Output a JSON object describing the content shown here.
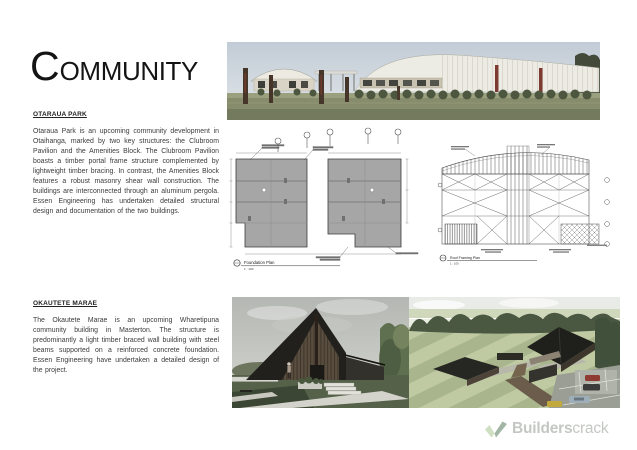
{
  "page": {
    "title_initial": "C",
    "title_rest": "OMMUNITY"
  },
  "sections": {
    "otaraua": {
      "heading": "OTARAUA PARK",
      "body": "Otaraua Park is an upcoming community development in Otaihanga, marked by two key structures: the Clubroom Pavilion and the Amenities Block. The Clubroom Pavilion boasts a timber portal frame structure complemented by lightweight timber bracing. In contrast, the Amenities Block features a robust masonry shear wall construction. The buildings are interconnected through an aluminum pergola. Essen Engineering has undertaken detailed structural design and documentation of the two buildings."
    },
    "okautete": {
      "heading": "OKAUTETE MARAE",
      "body": "The Okautete Marae is an upcoming Wharetipuna community building in Masterton. The structure is predominantly a light timber braced wall building with steel beams supported on a reinforced concrete foundation. Essen Engineering have undertaken a detailed design of the project."
    }
  },
  "drawings": {
    "foundation_plan": {
      "label": "Foundation Plan",
      "scale": "1 : 100"
    },
    "roof_plan": {
      "label": "Roof Framing Plan",
      "scale": "1 : 100"
    }
  },
  "logo": {
    "brand_bold": "Builders",
    "brand_light": "crack"
  },
  "colors": {
    "logo_text": "#c4c7c3",
    "logo_check_light": "#cfe0c2",
    "logo_check_dark": "#a3b5a4",
    "render_sky": "#c6d0da",
    "render_grass": "#878c6c",
    "plan_slab_grey": "#a6a6a6"
  }
}
